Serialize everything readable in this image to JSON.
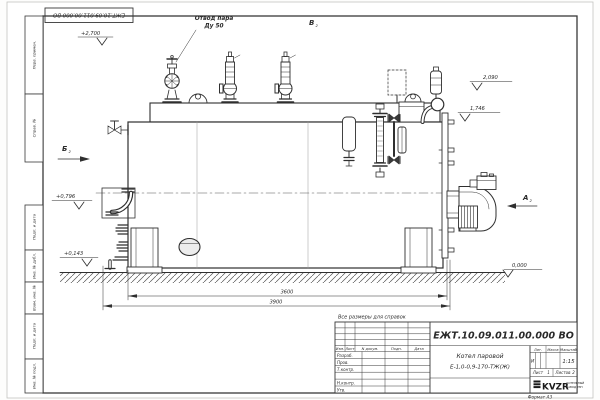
{
  "sheet": {
    "doc_number_top": "ЕЖТ.10.09.011.00.000  ВО",
    "reference_note": "Все размеры для справок",
    "format_note": "Формат А3"
  },
  "margin": {
    "stamps": [
      "Перв. примен.",
      "Справ. №",
      "Подп. и дата",
      "Инв. № дубл.",
      "Взам. инв. №",
      "Подп. и дата",
      "Инв. № подл."
    ]
  },
  "drawing": {
    "callouts": {
      "steam_outlet_1": "Отвод пара",
      "steam_outlet_2": "Ду 50"
    },
    "views": {
      "v": "В",
      "b": "Б",
      "a": "А",
      "sheet_ref": "2"
    },
    "elevations": {
      "e2700": "+2,700",
      "e2090": "2,090",
      "e1746": "1,746",
      "e0796": "+0,796",
      "e0143": "+0,143",
      "e0000": "0,000"
    },
    "dimensions": {
      "shell_length": "3600",
      "overall_length": "3900"
    }
  },
  "title_block": {
    "doc_number": "ЕЖТ.10.09.011.00.000  ВО",
    "product_1": "Котел паровой",
    "product_2": "Е-1,0-0,9-170-ТЖ(Ж)",
    "change_header": {
      "izm": "Изм.",
      "list": "Лист",
      "ndoc": "N докум.",
      "podp": "Подп.",
      "data": "Дата"
    },
    "roles": {
      "razrab": "Разраб.",
      "prov": "Пров.",
      "tkontr": "Т.контр.",
      "nkontr": "Н.контр.",
      "utv": "Утв."
    },
    "lit_label": "Лит.",
    "lit_value": "И",
    "mass_label": "Масса",
    "scale_label": "Масштаб",
    "scale_value": "1:15",
    "sheet_label": "Лист",
    "sheet_value": "1",
    "sheets_label": "Листов",
    "sheets_value": "2",
    "logo_text": "KVZR",
    "logo_sub1": "КОТЕЛЬНЫЙ",
    "logo_sub2": "ЗАВОД РЭП"
  }
}
